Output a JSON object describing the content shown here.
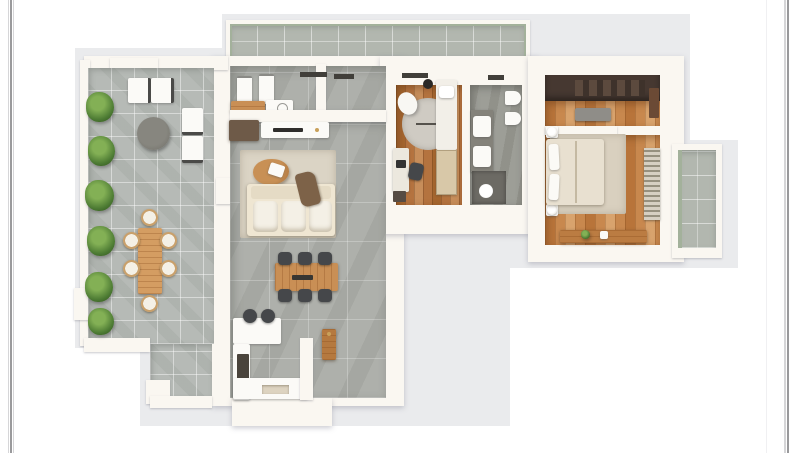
{
  "image_type": "3d-rendered apartment floor plan, top-down view on a white page",
  "palette": {
    "page_bg": "#ffffff",
    "edge_line_dark": "#9a9a9c",
    "edge_line_light": "#d6d6d8",
    "backdrop": "#eaebed",
    "wall": "#faf7f1",
    "terrace_tile": "#b6bab6",
    "balcony_tile": "#b2b7af",
    "balcony_edge": "#a3b19b",
    "interior_tile": "#aeb0ab",
    "bath_tile": "#9d9e97",
    "wood_a": "#b4733f",
    "wood_b": "#a5662f",
    "wood_bed_a": "#c8884e",
    "wood_bed_b": "#b8743a",
    "wood_furniture": "#c98f55",
    "fixture_white": "#fbfaf7",
    "cream_sofa": "#efe6d2",
    "cushion": "#f4f0e6",
    "wicker": "#c9a06b",
    "rug": "#dbd4c5",
    "rug_round": "#cfcbc3",
    "chair_dark": "#45474a",
    "dark_wood_cabinet": "#6e5a48",
    "closet_dark": "#463831",
    "shower_dark": "#6c6a64",
    "throw_brown": "#7d6248",
    "plant_dark": "#4c7a33",
    "plant_light": "#83b055",
    "lintel": "#413f3a",
    "brass": "#c9a05a",
    "appliance_dark": "#4a443c"
  },
  "scene": {
    "areas": [
      {
        "name": "upper-balcony",
        "floor": "grey-tile"
      },
      {
        "name": "terrace",
        "floor": "grey-tile",
        "furniture": [
          "lounge-chairs",
          "round-coffee-table",
          "outdoor-dining-table",
          "wicker-chairs",
          "planter-hedge"
        ]
      },
      {
        "name": "entry-hall",
        "floor": "grey-tile",
        "furniture": [
          "wall-panels",
          "bench",
          "washer"
        ]
      },
      {
        "name": "living-dining-room",
        "floor": "grey-tile",
        "furniture": [
          "tv-console",
          "dark-cabinet",
          "area-rug",
          "coffee-table",
          "sofa",
          "throw-blanket",
          "dining-table",
          "dining-chairs"
        ]
      },
      {
        "name": "kitchen",
        "floor": "grey-tile",
        "furniture": [
          "peninsula-counter",
          "bar-stools",
          "side-counter",
          "oven",
          "bottom-counter",
          "tall-wood-cabinet"
        ]
      },
      {
        "name": "office-bedroom",
        "floor": "wood",
        "furniture": [
          "single-bed",
          "closet",
          "round-rug",
          "lounge-ovoid-chair",
          "waste-bin",
          "desk",
          "desk-chair",
          "drawer-unit"
        ]
      },
      {
        "name": "bathroom",
        "floor": "grey-tile",
        "furniture": [
          "vanity-sinks",
          "toilet",
          "bidet",
          "shower"
        ]
      },
      {
        "name": "walk-in-closet",
        "floor": "wood",
        "furniture": [
          "wardrobe",
          "bench"
        ]
      },
      {
        "name": "master-bedroom",
        "floor": "wood",
        "furniture": [
          "double-bed",
          "pillows",
          "nightstands",
          "lamps",
          "area-rug",
          "shelf-wardrobe",
          "dresser"
        ]
      },
      {
        "name": "side-balcony",
        "floor": "grey-tile"
      }
    ]
  }
}
